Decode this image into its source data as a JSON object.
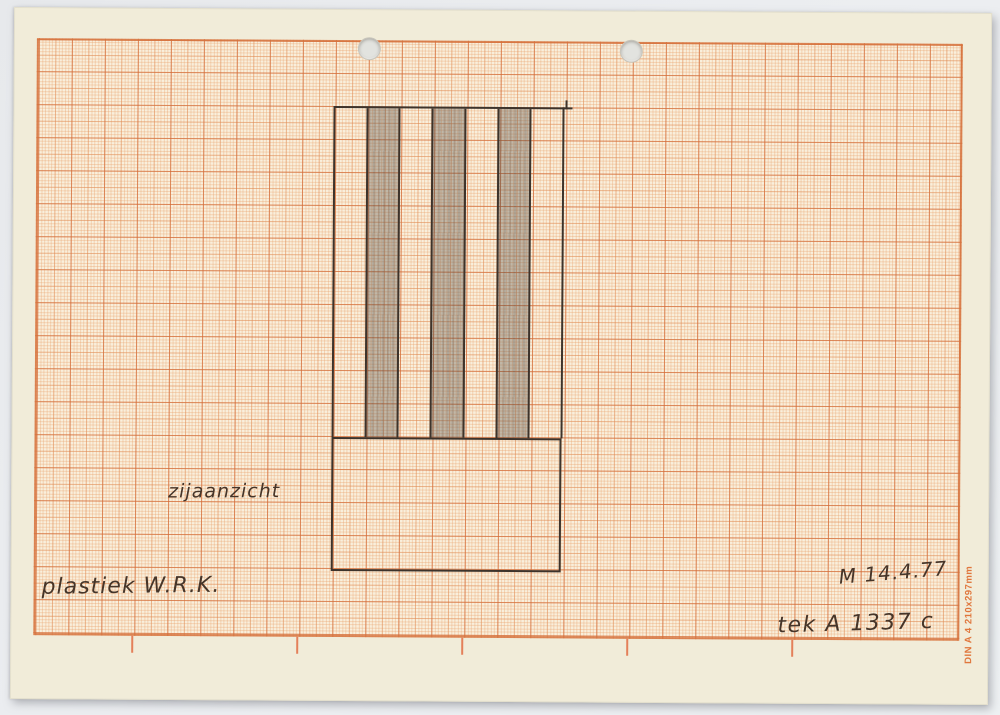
{
  "scan": {
    "background_color": "#e9ebee"
  },
  "paper": {
    "color": "#f1ecd9",
    "grid_line_color": "#d6733e",
    "spec_text": "DIN A 4 210x297mm",
    "punch_holes": 2
  },
  "annotations": {
    "view": "zijaanzicht",
    "artwork": "plastiek  W.R.K.",
    "signature_date": "M 14.4.77",
    "drawing_ref": "tek A 1337 c"
  },
  "drawing": {
    "description": "pencil side elevation: striped upper block on plain base",
    "column_count": 7,
    "shaded_columns": [
      2,
      4,
      6
    ],
    "pencil_color": "#3d332b",
    "shade_color": "rgba(92,82,75,0.36)"
  }
}
